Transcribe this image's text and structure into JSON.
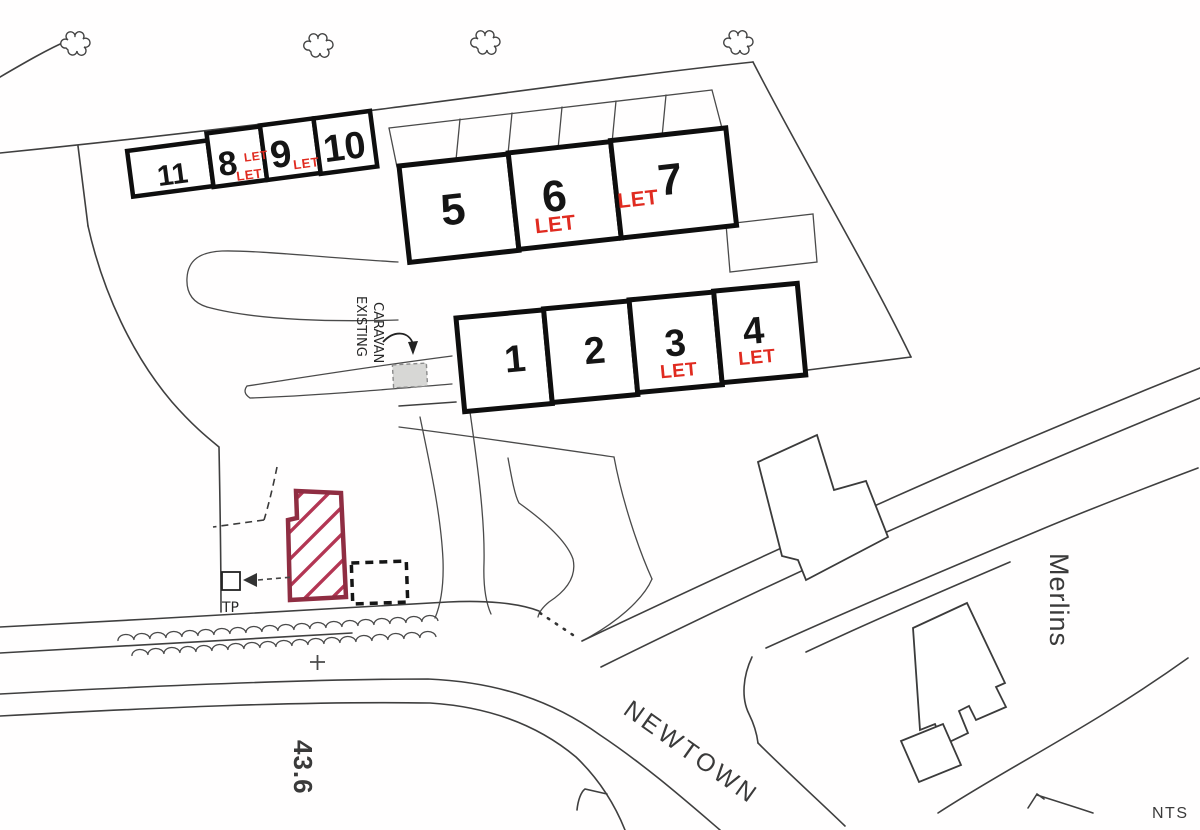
{
  "plots": {
    "row_top": [
      {
        "number": "11",
        "status": ""
      },
      {
        "number": "8",
        "status": "LET"
      },
      {
        "number": "9",
        "status": "LET"
      },
      {
        "number": "10",
        "status": "LET"
      }
    ],
    "row_middle": [
      {
        "number": "5",
        "status": ""
      },
      {
        "number": "6",
        "status": "LET"
      },
      {
        "number": "7",
        "status": "LET"
      }
    ],
    "row_bottom": [
      {
        "number": "1",
        "status": ""
      },
      {
        "number": "2",
        "status": ""
      },
      {
        "number": "3",
        "status": "LET"
      },
      {
        "number": "4",
        "status": "LET"
      }
    ]
  },
  "labels": {
    "existing_caravan_line1": "EXISTING",
    "existing_caravan_line2": "CARAVAN",
    "telegraph_pole": "TP",
    "road_name": "NEWTOWN",
    "property_name": "Merlins",
    "spot_level": "43.6",
    "scale_note": "NTS"
  },
  "colors": {
    "let_text": "#e02b20",
    "plot_border": "#0e0e0e",
    "building_outline": "#8f2d42",
    "building_hatch": "#b33654",
    "map_line": "#3f3f3f"
  }
}
